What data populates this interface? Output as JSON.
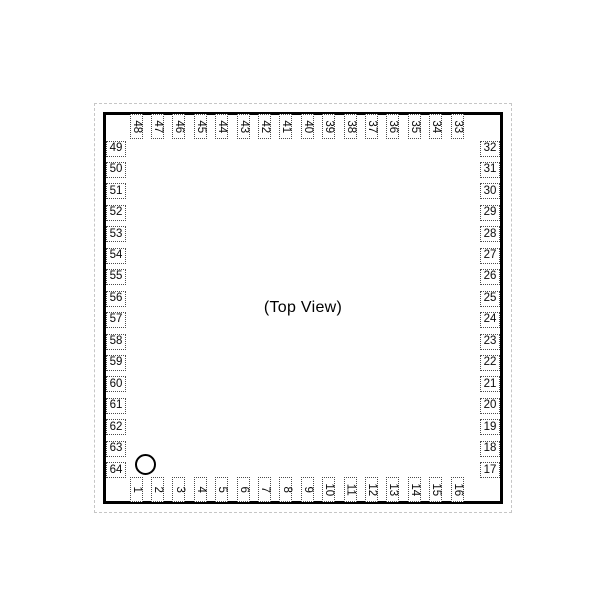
{
  "figure": {
    "center_label": "(Top View)",
    "pins": {
      "top": [
        "48",
        "47",
        "46",
        "45",
        "44",
        "43",
        "42",
        "41",
        "40",
        "39",
        "38",
        "37",
        "36",
        "35",
        "34",
        "33"
      ],
      "bottom": [
        "1",
        "2",
        "3",
        "4",
        "5",
        "6",
        "7",
        "8",
        "9",
        "10",
        "11",
        "12",
        "13",
        "14",
        "15",
        "16"
      ],
      "left": [
        "49",
        "50",
        "51",
        "52",
        "53",
        "54",
        "55",
        "56",
        "57",
        "58",
        "59",
        "60",
        "61",
        "62",
        "63",
        "64"
      ],
      "right": [
        "32",
        "31",
        "30",
        "29",
        "28",
        "27",
        "26",
        "25",
        "24",
        "23",
        "22",
        "21",
        "20",
        "19",
        "18",
        "17"
      ]
    },
    "colors": {
      "background": "#ffffff",
      "outline": "#000000",
      "pin_border": "#4a4a4a",
      "outer_dash": "#c6c6c6",
      "text": "#0a0a0a"
    }
  }
}
